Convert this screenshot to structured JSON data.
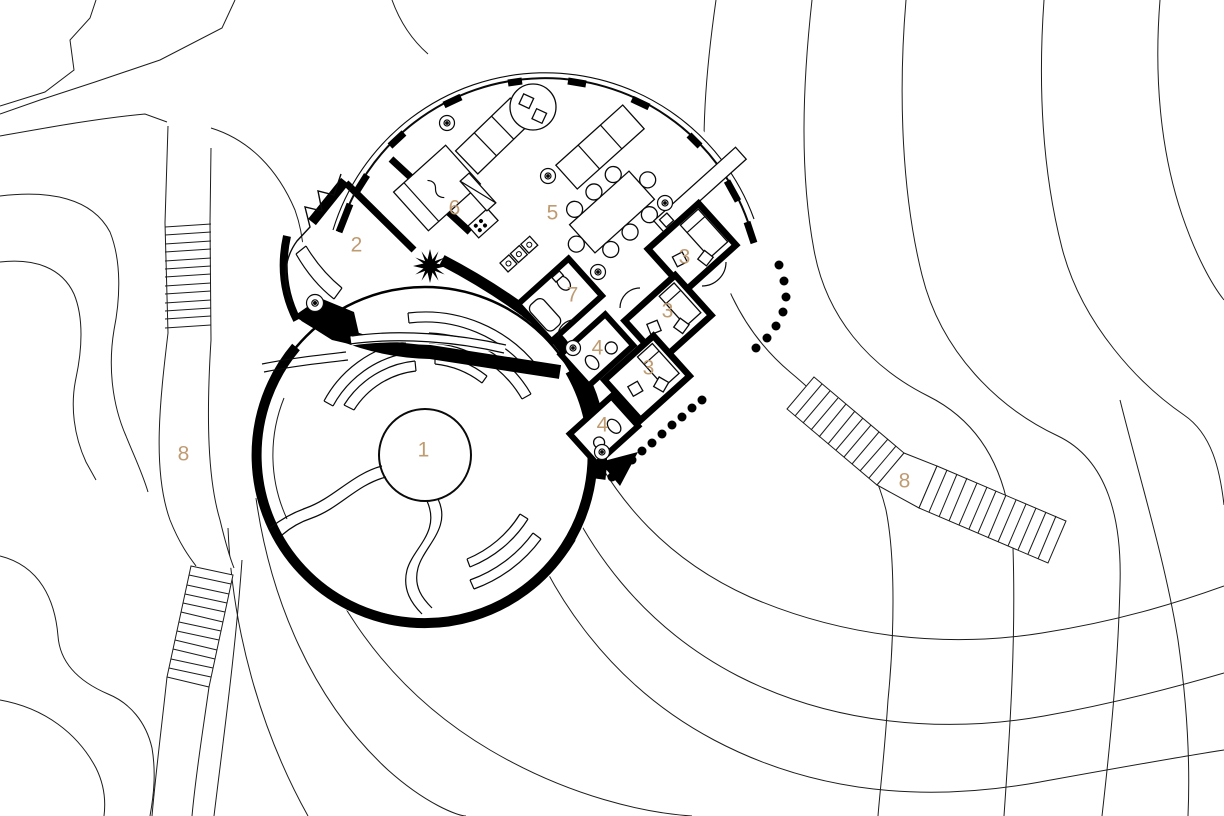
{
  "palette": {
    "line": "#000000",
    "label_accent": "#bf9b72",
    "background": "#ffffff"
  },
  "labels": {
    "items": [
      {
        "text": "1"
      },
      {
        "text": "2"
      },
      {
        "text": "5"
      },
      {
        "text": "6"
      },
      {
        "text": "7"
      },
      {
        "text": "3"
      },
      {
        "text": "3"
      },
      {
        "text": "3"
      },
      {
        "text": "4"
      },
      {
        "text": "4"
      },
      {
        "text": "8"
      },
      {
        "text": "8"
      }
    ]
  }
}
